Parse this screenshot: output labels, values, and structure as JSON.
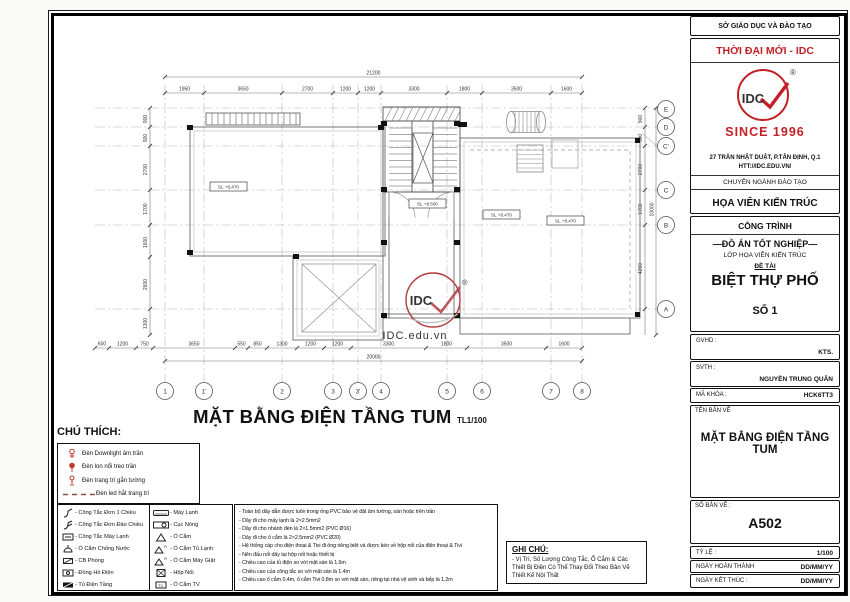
{
  "titleblock": {
    "dept": "SỞ GIÁO DỤC VÀ ĐÀO TẠO",
    "brand": "THỜI ĐẠI MỚI - IDC",
    "logo_text": "IDC",
    "logo_r": "®",
    "since": "SINCE 1996",
    "address1": "27 TRẦN NHẬT DUẬT, P.TÂN ĐỊNH, Q.1",
    "address2": "HTT://IDC.EDU.VN/",
    "major_label": "CHUYÊN NGÀNH ĐÀO TẠO",
    "major": "HỌA VIÊN KIẾN TRÚC",
    "project_label": "CÔNG TRÌNH",
    "project_type": "—ĐỒ ÁN TỐT NGHIỆP—",
    "class_line": "LỚP HỌA VIÊN KIẾN TRÚC",
    "topic_label": "ĐỀ TÀI",
    "topic": "BIỆT THỰ PHỐ",
    "number": "SỐ 1",
    "gvhd_label": "GVHD :",
    "gvhd": "KTS.",
    "svth_label": "SVTH :",
    "svth": "NGUYỄN TRUNG QUÂN",
    "code_label": "MÃ KHÓA :",
    "code": "HCK6TT3",
    "sheetname_label": "TÊN BẢN VẼ",
    "sheetname": "MẶT BẰNG ĐIỆN TẦNG TUM",
    "sheetno_label": "SỐ BẢN VẼ :",
    "sheetno": "A502",
    "scale_label": "TỶ LỆ :",
    "scale": "1/100",
    "date1_label": "NGÀY HOÀN THÀNH",
    "date1": "DD/MM/YY",
    "date2_label": "NGÀY KẾT THÚC :",
    "date2": "DD/MM/YY"
  },
  "drawing": {
    "title": "MẶT BẰNG ĐIỆN TẦNG TUM",
    "title_scale": "TL1/100",
    "watermark": "IDC.edu.vn",
    "stamp_text": "IDC",
    "stamp_r": "®",
    "levels": [
      "SL +8.470",
      "SL +8.500",
      "SL +8.470",
      "SL +8.470"
    ],
    "grid_cols": [
      "1",
      "1'",
      "2",
      "3",
      "3'",
      "4",
      "5",
      "6",
      "7",
      "8"
    ],
    "grid_rows": [
      "E",
      "D",
      "C'",
      "C",
      "B",
      "A"
    ],
    "dims_top_total": "21200",
    "dims_top": [
      "1950",
      "3650",
      "2700",
      "1200",
      "1200",
      "3300",
      "1800",
      "3500",
      "1600"
    ],
    "dims_bottom": [
      "600",
      "1200",
      "750",
      "3650",
      "550",
      "850",
      "1300",
      "1200",
      "1200",
      "3300",
      "1800",
      "3500",
      "1600"
    ],
    "dims_bottom_total": "20000",
    "dims_left": [
      "900",
      "500",
      "2700",
      "1700",
      "1600",
      "2600",
      "1300"
    ],
    "dims_right": [
      "900",
      "500",
      "2700",
      "1700",
      "4200"
    ],
    "dims_right_total": "10000"
  },
  "legend": {
    "title": "CHÚ THÍCH:",
    "lamps": [
      "Đèn Downlight âm trần",
      "Đèn lon nổi treo trần",
      "Đèn trang trí gắn tường",
      "Đèn led hắt trang trí"
    ],
    "col1": [
      "- Công Tắc Đơn 1 Chiều",
      "- Công Tắc Đơn Đảo Chiều",
      "- Công Tắc Máy Lạnh",
      "- Ổ Cắm Chống Nước",
      "- CB Phòng",
      "- Đồng Hồ Điện",
      "- Tủ Điện Tầng"
    ],
    "col2": [
      "- Máy Lạnh",
      "- Cục Nóng",
      "- Ổ Cắm",
      "- Ổ Cắm Tủ Lạnh",
      "- Ổ Cắm Máy Giặt",
      "- Hộp Nối",
      "- Ổ Cắm TV"
    ]
  },
  "notes": [
    "- Toàn bộ dây dẫn được luồn trong ống PVC bảo vệ đặt âm tường, sàn hoặc trên trần",
    "- Dây đi cho máy lạnh là 2×2.5mm2",
    "- Dây đi cho nhánh đèn là 2×1.5mm2 (PVC Ø16)",
    "- Dây đi cho ổ cắm là 2×2.5mm2 (PVC Ø20)",
    "- Hệ thống cáp cho điện thoại & Tivi đi ống riêng biệt và được kéo về hộp nối của điện thoại & Tivi",
    "- Nên đấu nối dây tại hộp nối hoặc thiết bị",
    "- Chiều cao của tủ điện so với mặt sàn là 1.6m",
    "- Chiều cao của công tắc so với mặt sàn là 1.4m",
    "- Chiều cao ổ cắm 0,4m, ổ cắm Tivi 0.8m so với mặt sàn, riêng tại nhà vệ sinh và bếp là 1.2m"
  ],
  "ghichu": {
    "title": "GHI CHÚ:",
    "body": "- Vị Trí, Số Lượng Công Tắc, Ổ Cắm & Các Thiết Bị Điện Có Thể Thay Đổi Theo Bản Vẽ Thiết Kế Nội Thất"
  }
}
